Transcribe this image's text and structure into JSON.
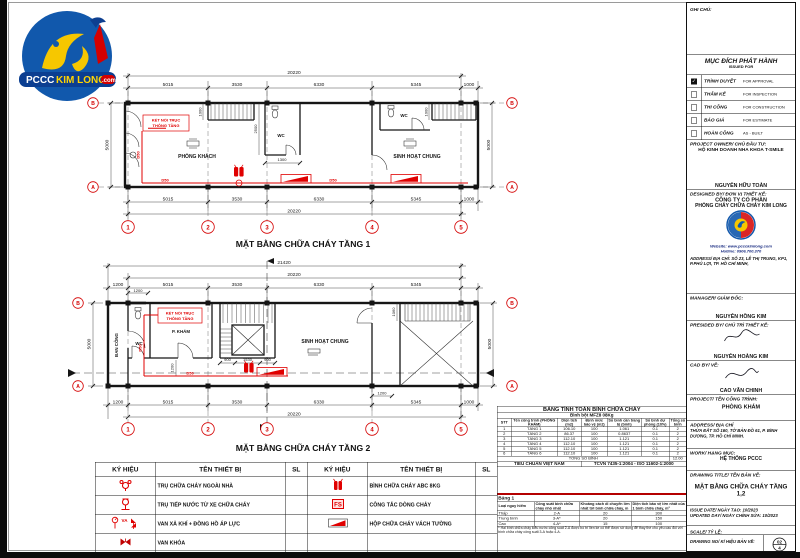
{
  "logo": {
    "pccc": "PCCC",
    "kimlong": "KIM LONG",
    "com": ".com"
  },
  "plan1": {
    "title": "MẶT BẰNG CHỮA CHÁY TẦNG 1",
    "total_top": "20220",
    "total_bottom": "20220",
    "segs": [
      "5015",
      "3530",
      "6330",
      "5345",
      "1000"
    ],
    "segs_b": [
      "5015",
      "3530",
      "6330",
      "5345",
      "1000"
    ],
    "dim_left": "5000",
    "dim_right": "5000",
    "grids": [
      "1",
      "2",
      "3",
      "4",
      "5"
    ],
    "row_top": "B",
    "row_bottom": "A",
    "room1": "PHÒNG KHÁCH",
    "room2": "SINH HOẠT CHUNG",
    "wc1": "WC",
    "wc2": "WC",
    "note1": "KẾT NỐI TRỤC",
    "note2": "THÔNG TẦNG",
    "d50": "D50",
    "dim_1300": "1300",
    "dim_2500": "2500",
    "dim_1000a": "1000",
    "dim_1000b": "1000"
  },
  "plan2": {
    "title": "MẶT BẰNG CHỮA CHÁY TẦNG 2",
    "total_top": "21420",
    "sub_total": "20220",
    "total_bottom": "20220",
    "segs": [
      "1200",
      "5015",
      "3530",
      "6330",
      "5345"
    ],
    "segs_b": [
      "1200",
      "5015",
      "3530",
      "6330",
      "5345",
      "1000"
    ],
    "dim_left": "5000",
    "dim_right": "5000",
    "grids": [
      "1",
      "2",
      "3",
      "4",
      "5"
    ],
    "row_top": "B",
    "row_bottom": "A",
    "balcony": "BAN CÔNG",
    "wc": "WC",
    "room1": "P. KHÁM",
    "room2": "SINH HOẠT CHUNG",
    "note1": "KẾT NỐI TRỤC",
    "note2": "THÔNG TẦNG",
    "d50": "D50",
    "dim_1200_top": "1200",
    "dim_900a": "900",
    "dim_1530": "1530",
    "dim_900b": "900",
    "dim_1200_mid": "1200",
    "dim_1060": "1060",
    "dim_1200_g4": "1200"
  },
  "calc_table": {
    "title": "BẢNG TÍNH TOÁN BÌNH CHỮA CHÁY",
    "subtitle": "Bình bột MFZ8 08Kg",
    "headers": [
      "STT",
      "Tên công trình (PHÒNG KHÁM)",
      "Diện tích (m2)",
      "Định mức bảo vệ (m2)",
      "Số bình cần trang bị (bình)",
      "Số bình dự phòng (10%)",
      "Tổng số bình"
    ],
    "rows": [
      [
        "1",
        "TẦNG 1",
        "106.10",
        "100",
        "1.061",
        "0.1",
        "2"
      ],
      [
        "2",
        "TẦNG 2",
        "86.37",
        "100",
        "0.8637",
        "0.1",
        "2"
      ],
      [
        "3",
        "TẦNG 3",
        "112.10",
        "100",
        "1.121",
        "0.1",
        "2"
      ],
      [
        "4",
        "TẦNG 4",
        "112.10",
        "100",
        "1.121",
        "0.1",
        "2"
      ],
      [
        "5",
        "TẦNG 5",
        "112.10",
        "100",
        "1.121",
        "0.1",
        "2"
      ],
      [
        "6",
        "TẦNG 6",
        "112.10",
        "100",
        "1.121",
        "0.1",
        "2"
      ]
    ],
    "total_label": "TỔNG SỐ BÌNH",
    "total_value": "12.00",
    "footer_left": "TIÊU CHUẨN VIỆT NAM",
    "footer_right": "TCVN 7435-1:2004 - ISO 11602-1:2000"
  },
  "legend": {
    "headers": [
      "KÝ HIỆU",
      "TÊN THIẾT BỊ",
      "SL",
      "KÝ HIỆU",
      "TÊN THIẾT BỊ",
      "SL"
    ],
    "left": [
      "TRỤ CHỮA CHÁY NGOÀI NHÀ",
      "TRỤ TIẾP NƯỚC TỪ XE CHỮA CHÁY",
      "VAN XẢ KHÍ + ĐỒNG HỒ ÁP LỰC",
      "VAN KHÓA"
    ],
    "right": [
      "BÌNH CHỮA CHÁY ABC 8KG",
      "CÔNG TẮC DÒNG CHẢY",
      "HỘP CHỮA CHÁY VÁCH TƯỜNG",
      ""
    ],
    "va": "VA",
    "fs": "FS"
  },
  "table1": {
    "title": "Bảng 1",
    "headers": [
      "Loại nguy hiểm",
      "Công suất bình chữa cháy nhỏ nhất",
      "Khoảng cách di chuyển lớn nhất tới bình chữa cháy, m",
      "Diện tích bảo vệ lớn nhất của 1 bình chữa cháy, m²"
    ],
    "rows": [
      [
        "Thấp",
        "2-A",
        "20",
        "300"
      ],
      [
        "Trung bình",
        "3-A*",
        "20",
        "150"
      ],
      [
        "Cao",
        "4-A*",
        "15",
        "100"
      ]
    ],
    "footnote": "* Hai bình chữa cháy kiểu nước công suất 2-A được bố trí liền kề có thể được sử dụng để thay thế cho yêu cầu đối với bình chữa cháy công suất 3-A hoặc 4-A."
  },
  "titleblock": {
    "ghi_chu": "GHI CHÚ:",
    "issued_title": "MỤC ĐÍCH PHÁT HÀNH",
    "issued_sub": "ISSUED FOR",
    "checks": [
      {
        "vn": "TRÌNH DUYỆT",
        "en": "FOR APPROVAL",
        "checked": true
      },
      {
        "vn": "THẨM KẾ",
        "en": "FOR INSPECTION",
        "checked": false
      },
      {
        "vn": "THI CÔNG",
        "en": "FOR CONSTRUCTION",
        "checked": false
      },
      {
        "vn": "BÁO GIÁ",
        "en": "FOR ESTIMATE",
        "checked": false
      },
      {
        "vn": "HOÀN CÔNG",
        "en": "AS - BUILT",
        "checked": false
      }
    ],
    "owner_label": "PROJECT OWNER/ CHỦ ĐẦU TƯ:",
    "owner_name": "HỘ KINH DOANH NHA KHOA T-SMILE",
    "owner_sign": "NGUYỄN HỮU TOÀN",
    "designer_label": "DESIGNED BY/ ĐƠN VỊ THIẾT KẾ:",
    "company1": "CÔNG TY CỔ PHẦN",
    "company2": "PHÒNG CHÁY CHỮA CHÁY KIM LONG",
    "website": "Website: www.pccckimlong.com",
    "hotline": "Hotline: 0906.700.370",
    "addr_label": "ADDRESS/ ĐỊA CHỈ:",
    "addr1": "SỐ 23, LÊ THỊ TRUNG, KP1,",
    "addr2": "P.PHÚ LỢI, TP. HỒ CHÍ MINH,",
    "manager_label": "MANAGER/ GIÁM ĐỐC:",
    "manager_name": "NGUYỄN HỒNG KIM",
    "presided_label": "PRESIDED BY/ CHỦ TRÌ THIẾT KẾ:",
    "presided_name": "NGUYỄN HOÀNG KIM",
    "cad_label": "CAD BY/ VẼ:",
    "cad_name": "CAO VĂN CHINH",
    "project_label": "PROJECT/ TÊN CÔNG TRÌNH:",
    "project_name": "PHÒNG KHÁM",
    "addr2_label": "ADDRESS/ ĐỊA CHỈ",
    "addr2_text": "THỬA ĐẤT SỐ 160, TỜ BẢN ĐỒ 61, P. BÌNH DƯƠNG, TP. HỒ CHÍ MINH.",
    "work_label": "WORK/ HẠNG MỤC:",
    "work_value": "HỆ THỐNG PCCC",
    "drawing_label": "DRAWING TITLE/ TÊN BẢN VẼ:",
    "drawing_value": "MẶT BẰNG CHỮA CHÁY TẦNG 1,2",
    "issue_label": "ISSUE DATE/ NGÀY TẠO:",
    "issue_value": "10/2023",
    "updated_label": "UPDATED DAY/ NGÀY CHỈNH SỬA:",
    "updated_value": "10/2023",
    "scale_label": "SCALE/ TỶ LỆ:",
    "no_label": "DRAWING NO/ KÍ HIỆU BẢN VẼ:",
    "no_value": "02",
    "no_value2": "4",
    "paper_label": "PAPER SIZE/ KHỔ GIẤY:",
    "paper_value": "A3"
  }
}
